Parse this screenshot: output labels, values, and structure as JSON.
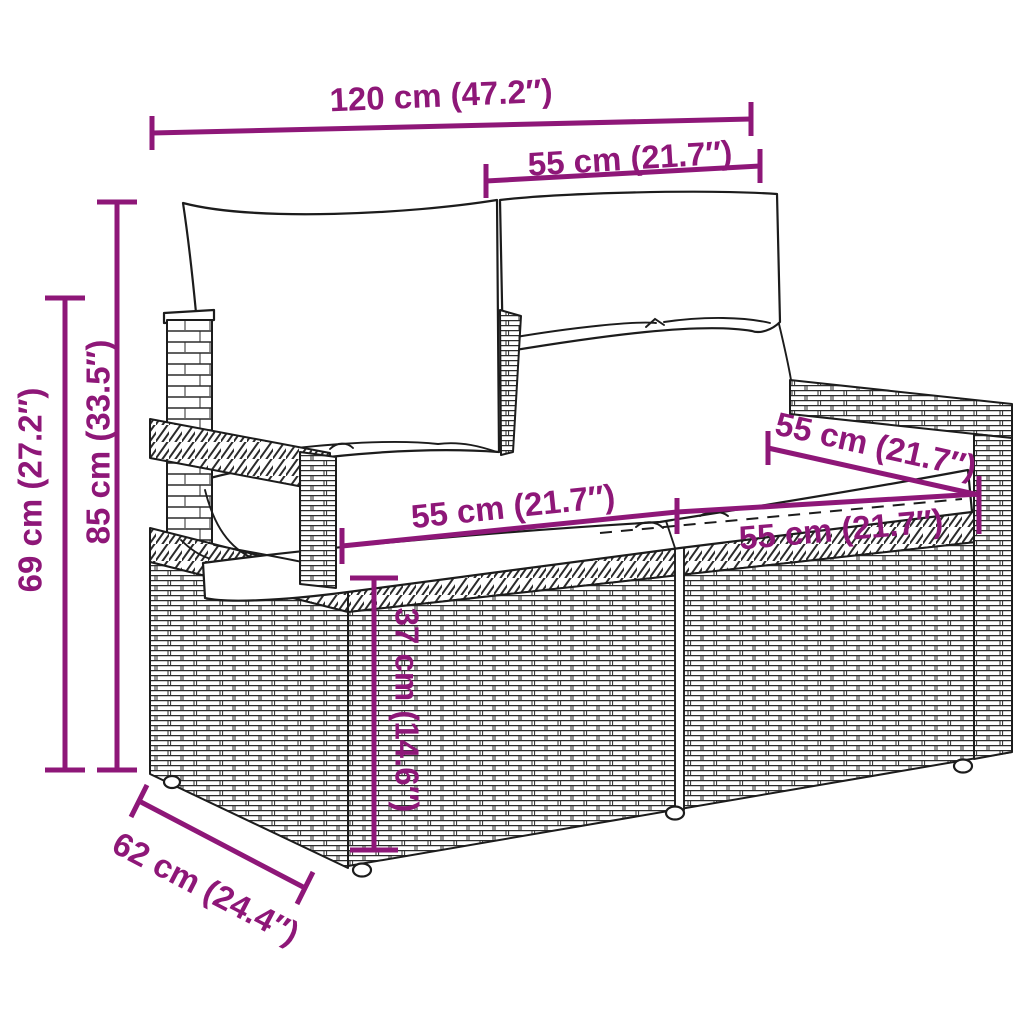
{
  "diagram": {
    "subject": "poly rattan two-seater garden sofa with back and seat cushions",
    "style": "black line-art product drawing with magenta dimension annotations on white background",
    "colors": {
      "dimension": "#8E1778",
      "outline": "#1c1c1c",
      "background": "#ffffff"
    },
    "units": {
      "primary": "cm",
      "secondary": "inches"
    },
    "dimensions": [
      {
        "name": "overall_width",
        "value_cm": 120,
        "value_in": 47.2,
        "label": "120 cm (47.2″)",
        "orientation": "horizontal",
        "placement": "top"
      },
      {
        "name": "back_cushion_width",
        "value_cm": 55,
        "value_in": 21.7,
        "label": "55 cm (21.7″)",
        "orientation": "horizontal",
        "placement": "top-right"
      },
      {
        "name": "overall_height",
        "value_cm": 85,
        "value_in": 33.5,
        "label": "85 cm (33.5″)",
        "orientation": "vertical",
        "placement": "left-inner"
      },
      {
        "name": "armrest_height",
        "value_cm": 69,
        "value_in": 27.2,
        "label": "69 cm (27.2″)",
        "orientation": "vertical",
        "placement": "left-outer"
      },
      {
        "name": "armrest_top_depth",
        "value_cm": 55,
        "value_in": 21.7,
        "label": "55 cm (21.7″)",
        "orientation": "diagonal",
        "placement": "right-armrest"
      },
      {
        "name": "seat_width_left",
        "value_cm": 55,
        "value_in": 21.7,
        "label": "55 cm (21.7″)",
        "orientation": "horizontal",
        "placement": "seat-left"
      },
      {
        "name": "seat_width_right",
        "value_cm": 55,
        "value_in": 21.7,
        "label": "55 cm (21.7″)",
        "orientation": "horizontal",
        "placement": "seat-right"
      },
      {
        "name": "seat_height",
        "value_cm": 37,
        "value_in": 14.6,
        "label": "37 cm (14.6″)",
        "orientation": "vertical",
        "placement": "front-center"
      },
      {
        "name": "overall_depth",
        "value_cm": 62,
        "value_in": 24.4,
        "label": "62 cm (24.4″)",
        "orientation": "diagonal",
        "placement": "bottom-left"
      }
    ]
  }
}
